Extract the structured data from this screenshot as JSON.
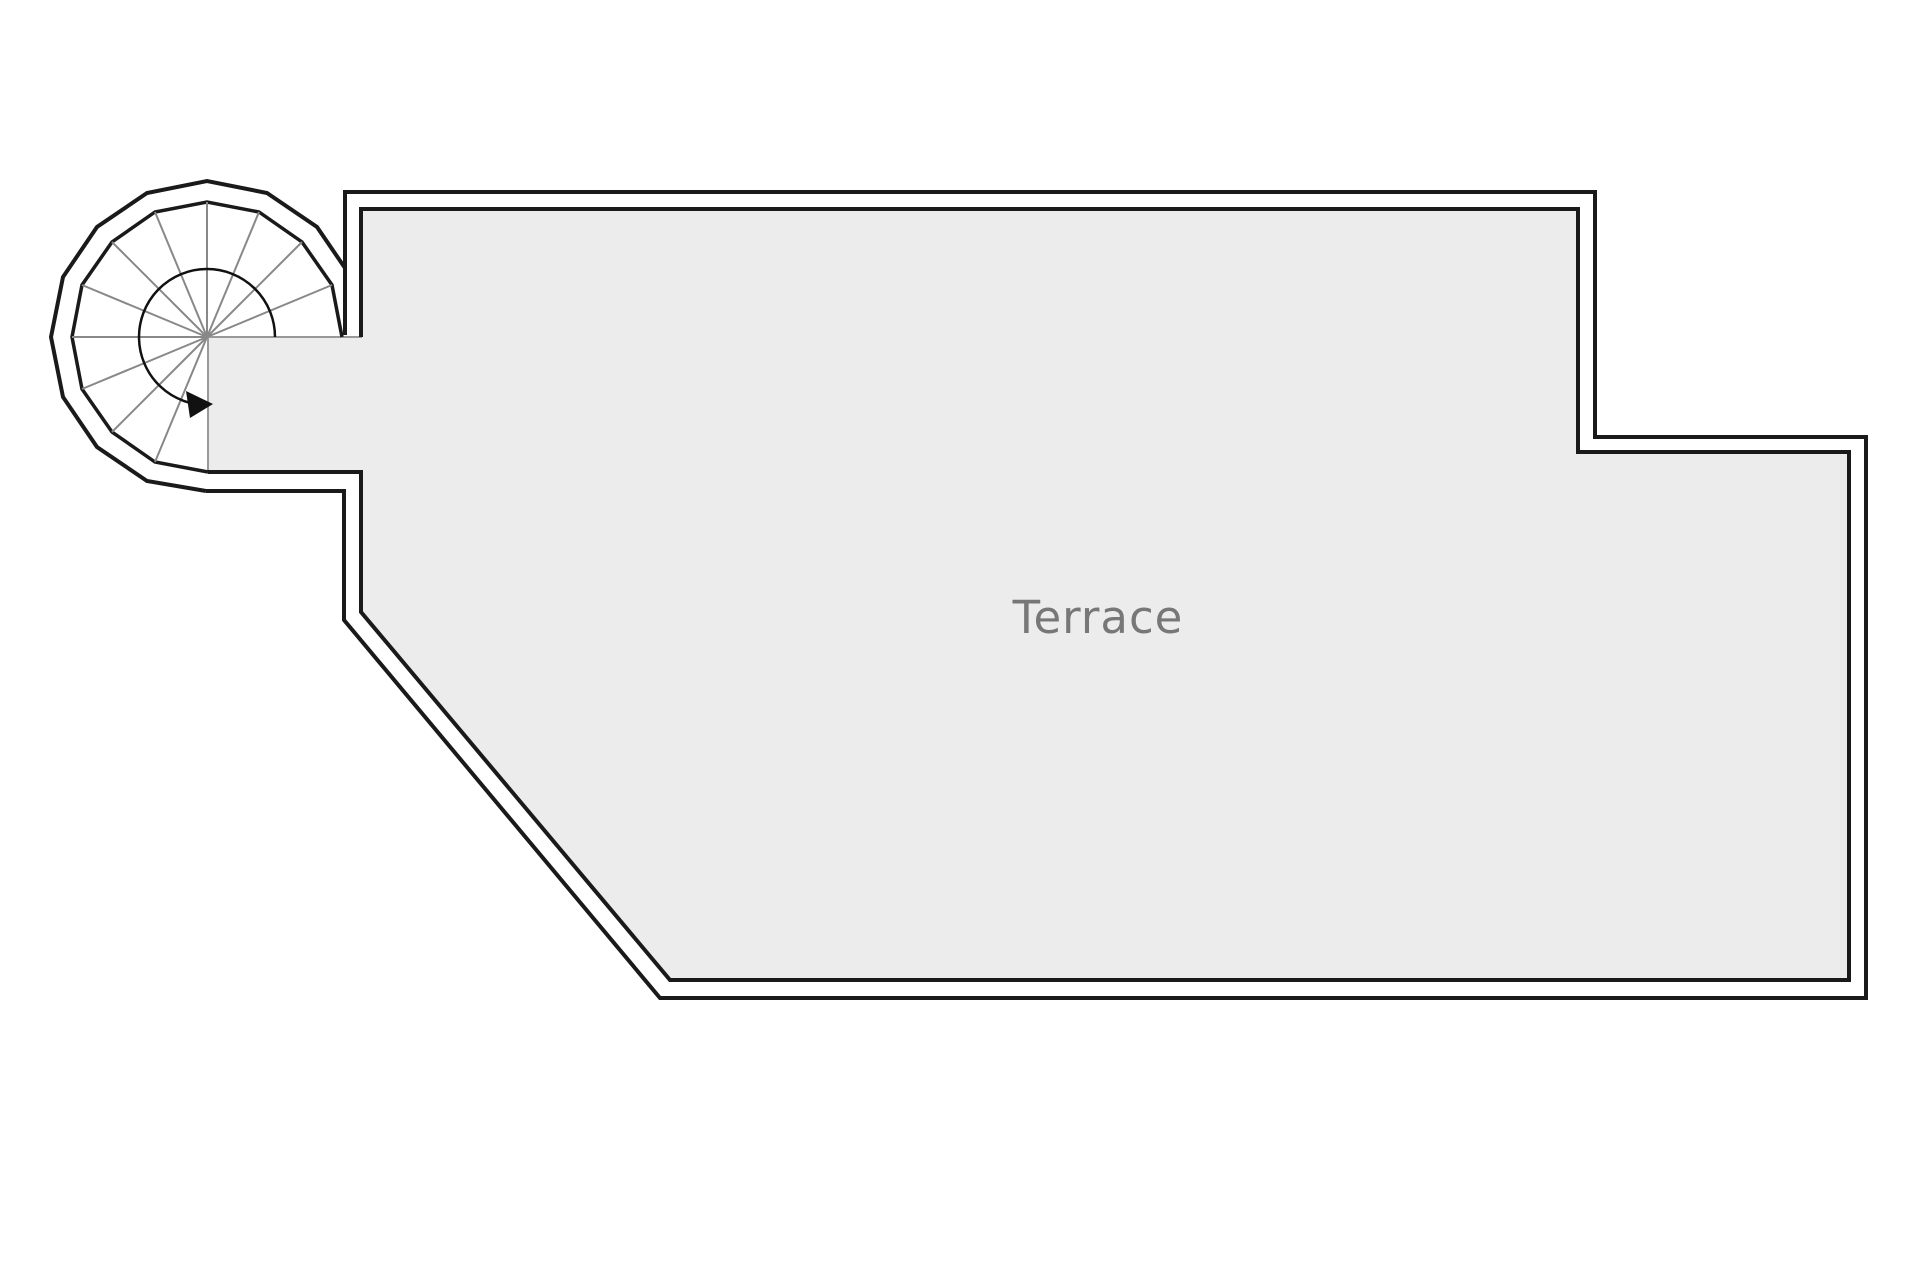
{
  "floorplan": {
    "room_label": "Terrace",
    "colors": {
      "background": "#ffffff",
      "floor_fill": "#ececec",
      "floor_open_edge": "#999999",
      "wall_stroke": "#1a1a1a",
      "tread_stroke": "#888888",
      "arrow": "#111111",
      "label_color": "#777777"
    },
    "staircase": {
      "type": "spiral",
      "visible_tread_lines": 13,
      "direction_arrow": "points-right-into-terrace"
    }
  }
}
